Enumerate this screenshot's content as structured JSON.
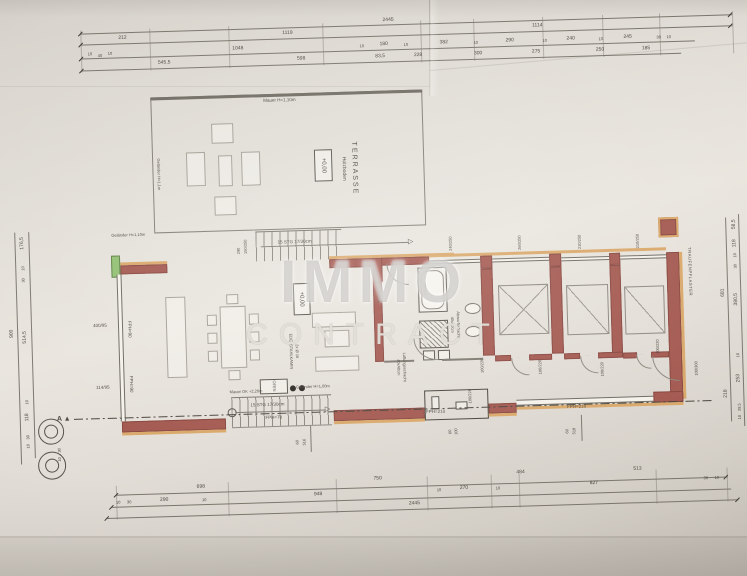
{
  "watermark": {
    "line1": "IMMO",
    "line2": "CONTRACT"
  },
  "terrace": {
    "name": "TERRASSE",
    "floor": "Holzboden",
    "level": "+0,00"
  },
  "living": {
    "level": "+0,00",
    "chimney_line1": "EDELSTAHLKAMIN",
    "chimney_line2": "2x Ø 16",
    "oven_label": "OFEN"
  },
  "site": {
    "eaves_label": "TRAUFENPFLASTER",
    "section_marker": "A ▲"
  },
  "dim_labels": [
    {
      "t": "2445",
      "x": 396,
      "y": 21
    },
    {
      "t": "212",
      "x": 130,
      "y": 31
    },
    {
      "t": "1119",
      "x": 295,
      "y": 31
    },
    {
      "t": "1114",
      "x": 545,
      "y": 31
    },
    {
      "t": "10",
      "x": 97,
      "y": 46,
      "s": 4
    },
    {
      "t": "40",
      "x": 107,
      "y": 48,
      "s": 4
    },
    {
      "t": "10",
      "x": 117,
      "y": 46,
      "s": 4
    },
    {
      "t": "1048",
      "x": 245,
      "y": 45
    },
    {
      "t": "10",
      "x": 369,
      "y": 46,
      "s": 4
    },
    {
      "t": "180",
      "x": 391,
      "y": 45
    },
    {
      "t": "10",
      "x": 413,
      "y": 46,
      "s": 4
    },
    {
      "t": "382",
      "x": 451,
      "y": 45
    },
    {
      "t": "10",
      "x": 483,
      "y": 46,
      "s": 4
    },
    {
      "t": "290",
      "x": 517,
      "y": 45
    },
    {
      "t": "10",
      "x": 552,
      "y": 46,
      "s": 4
    },
    {
      "t": "240",
      "x": 578,
      "y": 45
    },
    {
      "t": "10",
      "x": 608,
      "y": 46,
      "s": 4
    },
    {
      "t": "245",
      "x": 635,
      "y": 45
    },
    {
      "t": "30",
      "x": 666,
      "y": 46,
      "s": 4
    },
    {
      "t": "10",
      "x": 676,
      "y": 46,
      "s": 4
    },
    {
      "t": "545,5",
      "x": 171,
      "y": 57
    },
    {
      "t": "598",
      "x": 308,
      "y": 57
    },
    {
      "t": "83,5",
      "x": 387,
      "y": 57
    },
    {
      "t": "228",
      "x": 425,
      "y": 57
    },
    {
      "t": "300",
      "x": 485,
      "y": 57
    },
    {
      "t": "275",
      "x": 543,
      "y": 57
    },
    {
      "t": "250",
      "x": 607,
      "y": 57
    },
    {
      "t": "185",
      "x": 653,
      "y": 57
    },
    {
      "t": "698",
      "x": 195,
      "y": 482
    },
    {
      "t": "750",
      "x": 372,
      "y": 479
    },
    {
      "t": "484",
      "x": 515,
      "y": 477
    },
    {
      "t": "513",
      "x": 632,
      "y": 477
    },
    {
      "t": "10",
      "x": 112,
      "y": 495,
      "s": 4
    },
    {
      "t": "30",
      "x": 123,
      "y": 495,
      "s": 4
    },
    {
      "t": "290",
      "x": 158,
      "y": 494
    },
    {
      "t": "10",
      "x": 198,
      "y": 495,
      "s": 4
    },
    {
      "t": "948",
      "x": 312,
      "y": 493
    },
    {
      "t": "10",
      "x": 433,
      "y": 492,
      "s": 4
    },
    {
      "t": "270",
      "x": 458,
      "y": 491
    },
    {
      "t": "10",
      "x": 492,
      "y": 492,
      "s": 4
    },
    {
      "t": "827",
      "x": 588,
      "y": 490
    },
    {
      "t": "30",
      "x": 700,
      "y": 488,
      "s": 4
    },
    {
      "t": "10",
      "x": 711,
      "y": 488,
      "s": 4
    },
    {
      "t": "2445",
      "x": 408,
      "y": 505
    },
    {
      "t": "176,5",
      "x": 24,
      "y": 233,
      "r": -90
    },
    {
      "t": "10",
      "x": 24,
      "y": 258,
      "r": -90,
      "s": 4
    },
    {
      "t": "30",
      "x": 24,
      "y": 270,
      "r": -90,
      "s": 4
    },
    {
      "t": "514,5",
      "x": 24,
      "y": 327,
      "r": -90
    },
    {
      "t": "10",
      "x": 24,
      "y": 392,
      "r": -90,
      "s": 4
    },
    {
      "t": "118",
      "x": 24,
      "y": 407,
      "r": -90
    },
    {
      "t": "30",
      "x": 24,
      "y": 427,
      "r": -90,
      "s": 4
    },
    {
      "t": "10",
      "x": 24,
      "y": 436,
      "r": -90,
      "s": 4
    },
    {
      "t": "900",
      "x": 11,
      "y": 323,
      "r": -90
    },
    {
      "t": "30",
      "x": 55,
      "y": 441,
      "r": -90,
      "s": 4
    },
    {
      "t": "10",
      "x": 55,
      "y": 450,
      "r": -90,
      "s": 4
    },
    {
      "t": "58,5",
      "x": 736,
      "y": 235,
      "r": -90
    },
    {
      "t": "118",
      "x": 736,
      "y": 254,
      "r": -90
    },
    {
      "t": "10",
      "x": 736,
      "y": 266,
      "r": -90,
      "s": 4
    },
    {
      "t": "30",
      "x": 736,
      "y": 277,
      "r": -90,
      "s": 4
    },
    {
      "t": "380,5",
      "x": 736,
      "y": 310,
      "r": -90
    },
    {
      "t": "10",
      "x": 736,
      "y": 366,
      "r": -90,
      "s": 4
    },
    {
      "t": "253",
      "x": 736,
      "y": 389,
      "r": -90
    },
    {
      "t": "29,5",
      "x": 736,
      "y": 418,
      "r": -90,
      "s": 4
    },
    {
      "t": "10",
      "x": 736,
      "y": 428,
      "r": -90,
      "s": 4
    },
    {
      "t": "681",
      "x": 723,
      "y": 303,
      "r": -90
    },
    {
      "t": "218",
      "x": 723,
      "y": 404,
      "r": -90
    },
    {
      "t": "100/300",
      "x": 694,
      "y": 378,
      "r": -90,
      "s": 4
    },
    {
      "t": "100/220",
      "x": 656,
      "y": 355,
      "r": -90,
      "s": 4
    },
    {
      "t": "Mauer H=1,10m",
      "x": 285,
      "y": 98,
      "s": 4.5
    },
    {
      "t": "Geländer H=1,1m",
      "x": 162,
      "y": 168,
      "r": 90,
      "s": 4
    },
    {
      "t": "Geländer H=1,10m",
      "x": 130,
      "y": 228,
      "s": 4
    },
    {
      "t": "15 STG 17/30cm",
      "x": 296,
      "y": 240,
      "s": 4.5
    },
    {
      "t": "▷",
      "x": 412,
      "y": 243,
      "s": 7
    },
    {
      "t": "150/250",
      "x": 247,
      "y": 243,
      "r": -90,
      "s": 4
    },
    {
      "t": "290",
      "x": 240,
      "y": 247,
      "r": -90,
      "s": 4
    },
    {
      "t": "400/95",
      "x": 99,
      "y": 318,
      "s": 4.5
    },
    {
      "t": "FPH=90",
      "x": 128,
      "y": 322,
      "r": 90,
      "s": 4.5
    },
    {
      "t": "114/95",
      "x": 100,
      "y": 380,
      "s": 4.5
    },
    {
      "t": "FPH=90",
      "x": 128,
      "y": 377,
      "r": 90,
      "s": 4.5
    },
    {
      "t": "90/220",
      "x": 379,
      "y": 297,
      "r": -90,
      "s": 4
    },
    {
      "t": "180/80",
      "x": 425,
      "y": 291,
      "r": -90,
      "s": 4
    },
    {
      "t": "Abwurfschacht",
      "x": 457,
      "y": 327,
      "r": 90,
      "s": 4
    },
    {
      "t": "40x40cm",
      "x": 451,
      "y": 327,
      "r": 90,
      "s": 4
    },
    {
      "t": "Lüftungsschacht",
      "x": 402,
      "y": 368,
      "r": 90,
      "s": 4
    },
    {
      "t": "40x40cm",
      "x": 396,
      "y": 368,
      "r": 90,
      "s": 4
    },
    {
      "t": "240/250",
      "x": 452,
      "y": 246,
      "r": -90,
      "s": 4
    },
    {
      "t": "260/250",
      "x": 521,
      "y": 247,
      "r": -90,
      "s": 4
    },
    {
      "t": "210/250",
      "x": 581,
      "y": 248,
      "r": -90,
      "s": 4
    },
    {
      "t": "210/250",
      "x": 639,
      "y": 249,
      "r": -90,
      "s": 4
    },
    {
      "t": "100/220",
      "x": 480,
      "y": 369,
      "r": -90,
      "s": 4
    },
    {
      "t": "100/220",
      "x": 538,
      "y": 372,
      "r": -90,
      "s": 4
    },
    {
      "t": "100/220",
      "x": 600,
      "y": 376,
      "r": -90,
      "s": 4
    },
    {
      "t": "100/220",
      "x": 467,
      "y": 399,
      "r": -90,
      "s": 4
    },
    {
      "t": "FPH=210",
      "x": 432,
      "y": 414,
      "s": 4.5
    },
    {
      "t": "FPH=210",
      "x": 573,
      "y": 413,
      "s": 4.5
    },
    {
      "t": "Mauer OK +2,20m",
      "x": 243,
      "y": 388,
      "s": 4
    },
    {
      "t": "Geländer H=1,00m",
      "x": 310,
      "y": 385,
      "s": 4
    },
    {
      "t": "15 STG 17/30cm",
      "x": 264,
      "y": 402,
      "s": 4.5
    },
    {
      "t": "▷",
      "x": 324,
      "y": 408,
      "s": 7
    },
    {
      "t": "FPH=70",
      "x": 270,
      "y": 415,
      "s": 4.5
    },
    {
      "t": "516",
      "x": 300,
      "y": 440,
      "r": -90,
      "s": 4
    },
    {
      "t": "60",
      "x": 293,
      "y": 440,
      "r": -90,
      "s": 4
    },
    {
      "t": "518",
      "x": 570,
      "y": 437,
      "r": -90,
      "s": 4
    },
    {
      "t": "60",
      "x": 563,
      "y": 437,
      "r": -90,
      "s": 4
    },
    {
      "t": "100",
      "x": 452,
      "y": 434,
      "r": -90,
      "s": 4
    },
    {
      "t": "60",
      "x": 446,
      "y": 434,
      "r": -90,
      "s": 4
    }
  ]
}
